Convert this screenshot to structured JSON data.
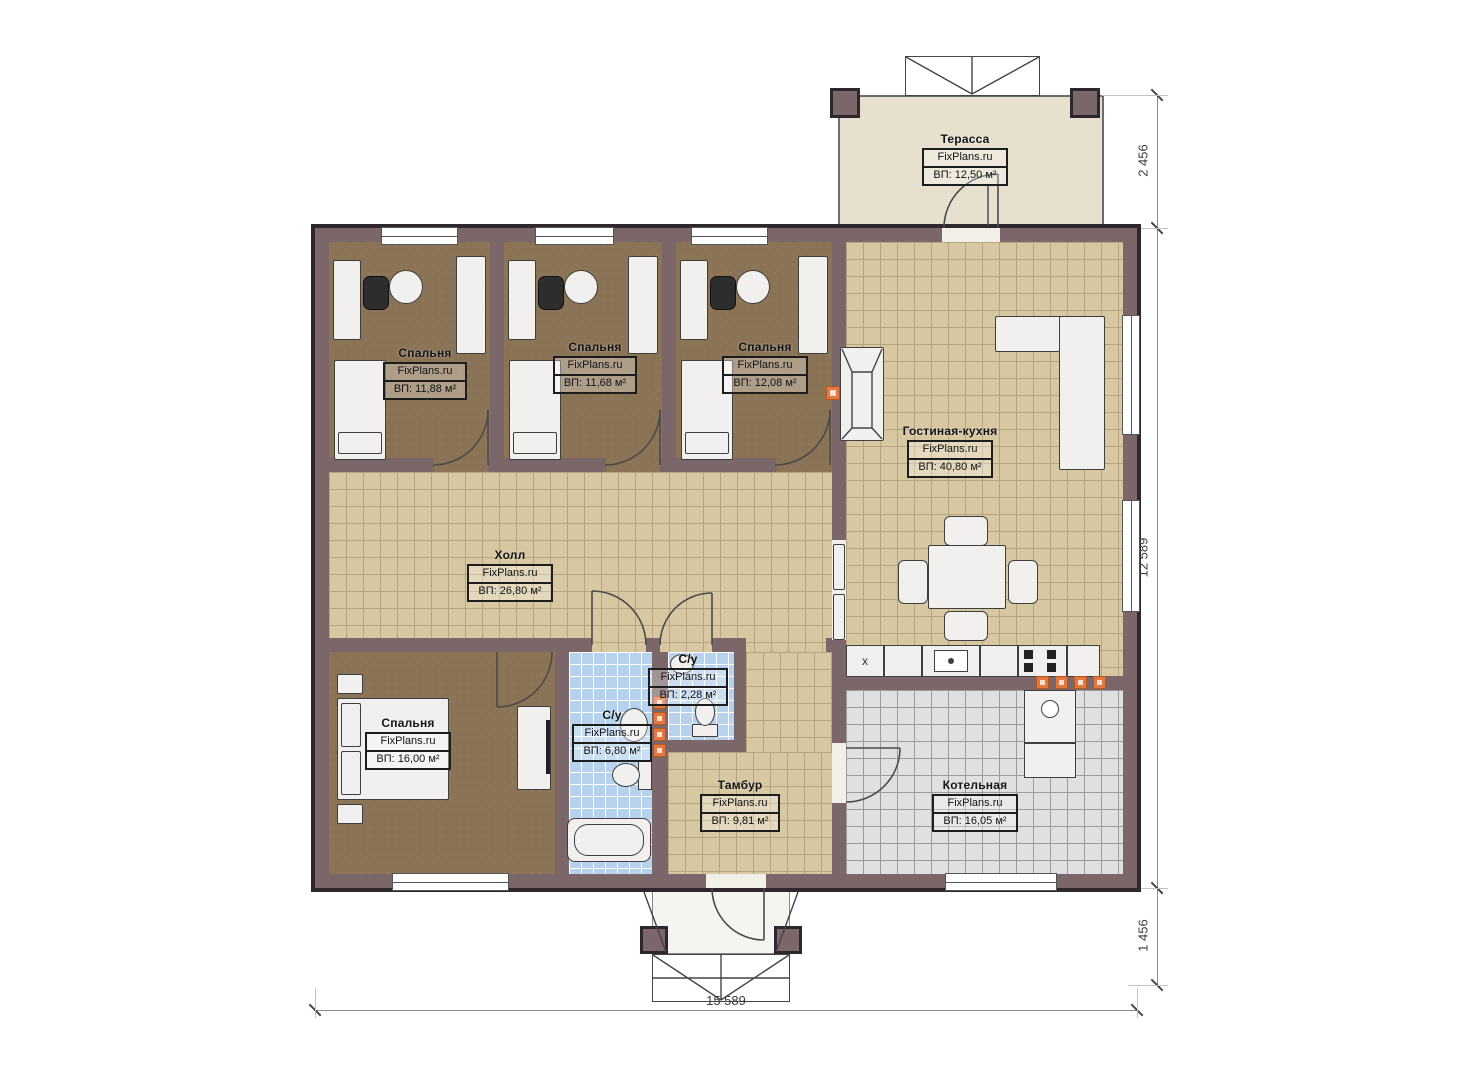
{
  "watermark": "FixPlans.ru",
  "rooms": {
    "terrace": {
      "name": "Терасса",
      "area": "ВП: 12,50 м²"
    },
    "bedroom1": {
      "name": "Спальня",
      "area": "ВП: 11,88 м²"
    },
    "bedroom2": {
      "name": "Спальня",
      "area": "ВП: 11,68 м²"
    },
    "bedroom3": {
      "name": "Спальня",
      "area": "ВП: 12,08 м²"
    },
    "living_kitchen": {
      "name": "Гостиная-кухня",
      "area": "ВП: 40,80 м²"
    },
    "hall": {
      "name": "Холл",
      "area": "ВП: 26,80 м²"
    },
    "wc_small": {
      "name": "С/у",
      "area": "ВП: 2,28 м²"
    },
    "bathroom": {
      "name": "С/у",
      "area": "ВП: 6,80 м²"
    },
    "bedroom4": {
      "name": "Спальня",
      "area": "ВП: 16,00 м²"
    },
    "vestibule": {
      "name": "Тамбур",
      "area": "ВП: 9,81 м²"
    },
    "boiler": {
      "name": "Котельная",
      "area": "ВП: 16,05 м²"
    }
  },
  "dimensions": {
    "terrace_depth": "2 456",
    "house_height": "12 589",
    "porch_depth": "1 456",
    "house_width": "15 589"
  },
  "markers": {
    "fridge": "x"
  },
  "colors": {
    "wall": "#7b666a",
    "wall_outline": "#2e272c",
    "bedroom_floor": "#8b7356",
    "tile_tan": "#d8c8a2",
    "tile_blue": "#b7d2ec",
    "tile_gray": "#e0e0e0",
    "terrace_floor": "#e8e0ce",
    "accent_orange": "#e4773f"
  }
}
